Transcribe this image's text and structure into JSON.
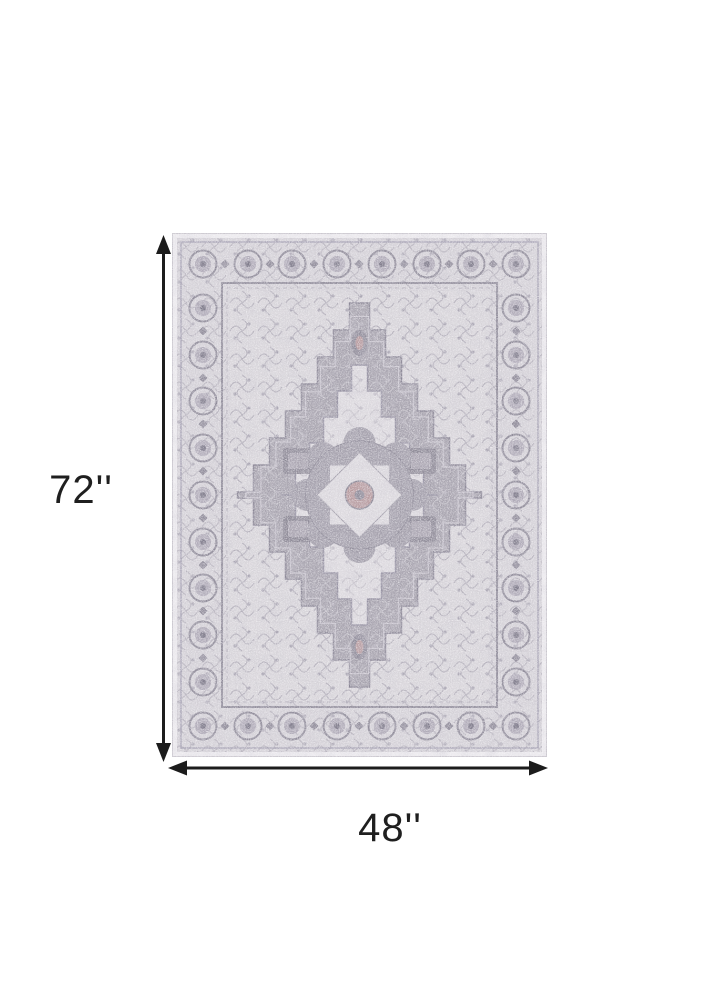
{
  "page": {
    "background_color": "#ffffff",
    "content": "product dimension diagram of an area rug"
  },
  "dimensions": {
    "height": {
      "label": "72''",
      "value": 72,
      "unit": "inches"
    },
    "width": {
      "label": "48''",
      "value": 48,
      "unit": "inches"
    }
  },
  "colors": {
    "arrow": "#1c1c1c",
    "label_text": "#1f1f1f",
    "rug": {
      "binding": "#eceaee",
      "border_bg": "#d5d2d8",
      "border_motif": "#8f8b99",
      "rosette_fill": "#b0abb8",
      "guard_stripe": "#9b97a6",
      "field": "#d8d5da",
      "diamond": "#a6a2ad",
      "medallion_cream": "#dcd9de",
      "medallion_gray": "#a29eaa",
      "accent_mauve": "#b79a9e",
      "tracery": "#aaa6b2",
      "block_dark": "#8b8694"
    }
  }
}
